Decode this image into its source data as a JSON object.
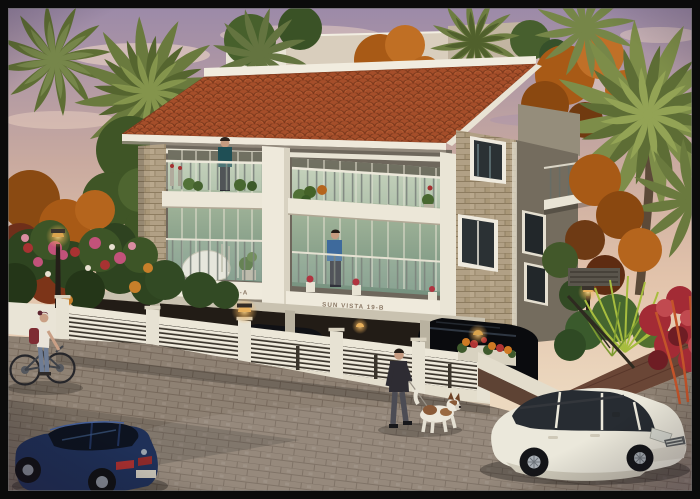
{
  "scene": {
    "type": "architectural exterior 3D render",
    "description": "Twin three-storey residential blocks 'Sun Vista 19-A' and 'Sun Vista 19-B' with red clay tile roof, stone-clad walls, planted balconies with residents, stilt parking behind a white slatted compound fence, palm and autumn trees at dusk; a woman wheels a bicycle, a man walks a dog, a dark blue hatchback and a white SUV are parked on the brick-paved street.",
    "signs": {
      "block_a": "SUN VISTA 19-A",
      "block_b": "SUN VISTA 19-B"
    },
    "colors": {
      "sky_top": "#9c8aa8",
      "sky_warm": "#e2c3ab",
      "roof_tile": "#a54e2a",
      "fascia_white": "#f1ecdf",
      "wall_white": "#eee9db",
      "stone": "#b1a085",
      "side_wall": "#746c5e",
      "balcony_glass": "#9cb096",
      "fence_white": "#efeadc",
      "road_paver": "#8e8173",
      "garage_dark": "#221c16",
      "car_blue": "#1f3058",
      "car_white": "#ebe8db",
      "suv_black": "#0a0b0e",
      "palm_green": "#6a7a3e",
      "autumn_orange": "#a85a16",
      "flower_red": "#a32b35",
      "lamp_glow": "#e9b15c"
    }
  }
}
